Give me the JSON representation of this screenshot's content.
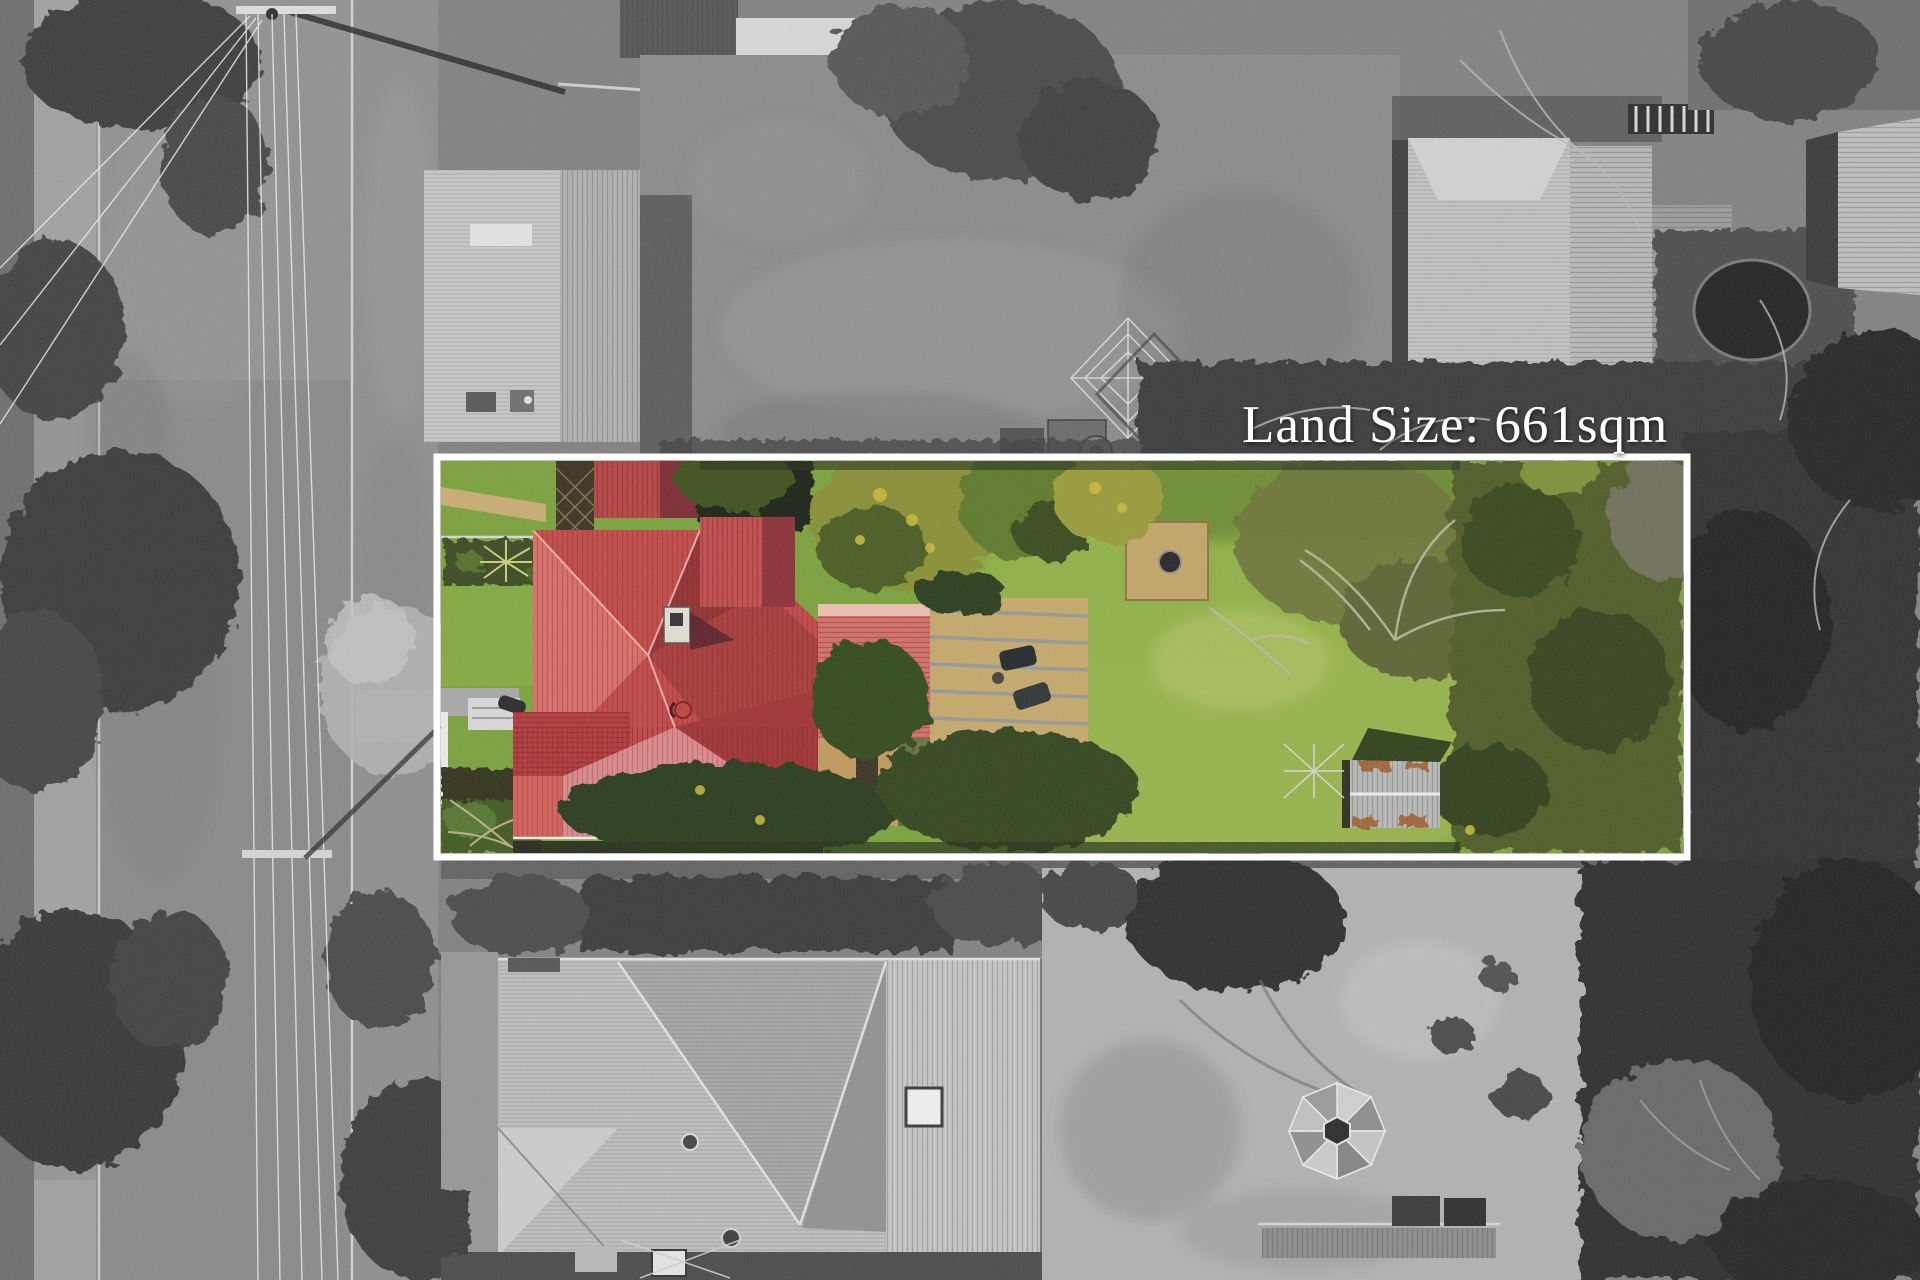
{
  "overlay": {
    "land_size_label": "Land Size: 661sqm",
    "text_color": "#ffffff",
    "border_color": "#ffffff"
  },
  "colors": {
    "highlight_roof_red": "#c14848",
    "highlight_roof_dark": "#9c3033",
    "highlight_roof_light": "#db8a8c",
    "lawn_green": "#7ba23c",
    "grayscale_base": "#828282"
  }
}
